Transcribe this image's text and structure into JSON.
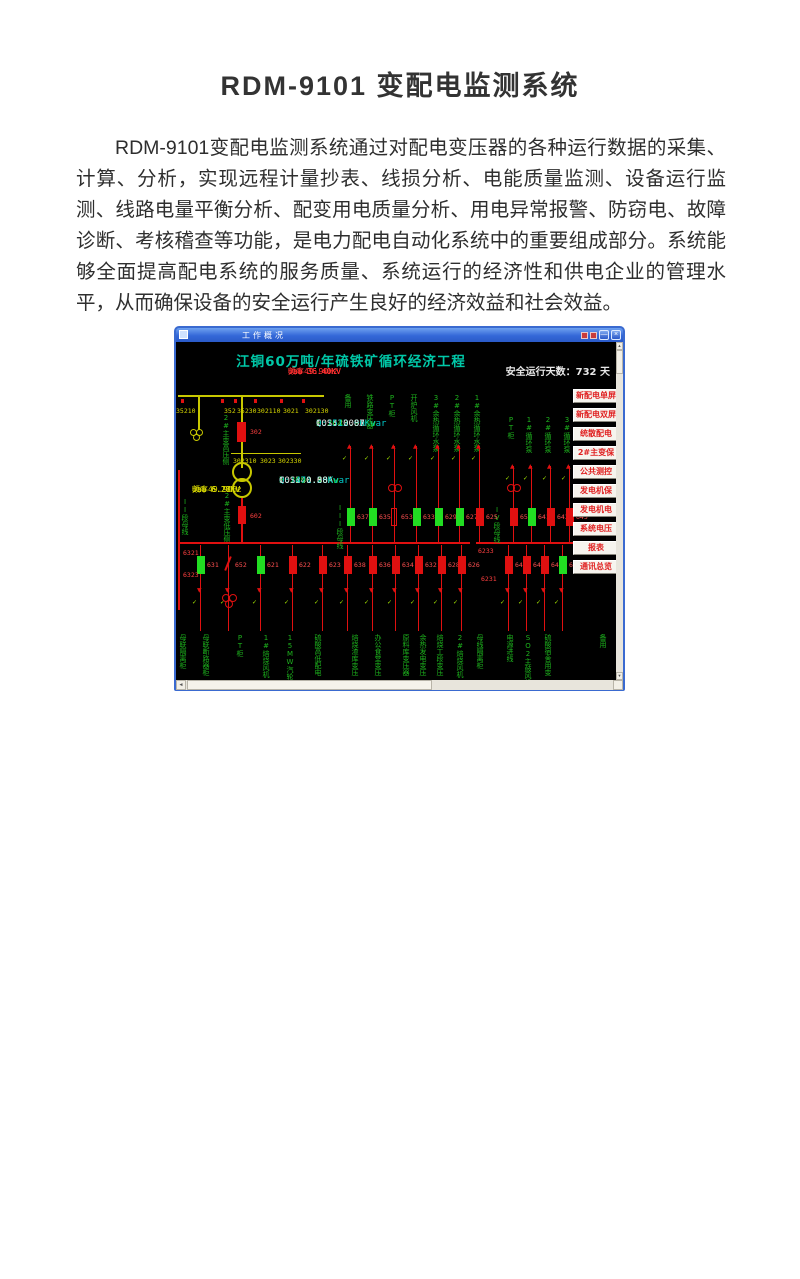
{
  "document": {
    "title": "RDM-9101 变配电监测系统",
    "paragraph": "RDM-9101变配电监测系统通过对配电变压器的各种运行数据的采集、计算、分析，实现远程计量抄表、线损分析、电能质量监测、设备运行监测、线路电量平衡分析、配变用电质量分析、用电异常报警、防窃电、故障诊断、考核稽查等功能，是电力配电自动化系统中的重要组成部分。系统能够全面提高配电系统的服务质量、系统运行的经济性和供电企业的管理水平，从而确保设备的安全运行产生良好的经济效益和社会效益。"
  },
  "window": {
    "title": "工作概况",
    "controls": {
      "minimize": "—",
      "close": "×"
    },
    "menu_buttons": [
      "新配电单屏",
      "新配电双屏",
      "统散配电",
      "2#主变保",
      "公共测控",
      "发电机保",
      "发电机电",
      "系统电压",
      "报表",
      "通讯总览"
    ],
    "scada": {
      "project_title": "江铜60万吨/年硫铁矿循环经济工程",
      "safe_days": "安全运行天数：732 天",
      "hv_readings": [
        "Uab 36.40KV",
        "Ubc 36.40KV",
        "Uca 36.40KV",
        "频率49.90Hz"
      ],
      "switch_row1": [
        "35210",
        "352",
        "35230",
        "302110",
        "3021",
        "302130"
      ],
      "switch_row2": [
        "302310",
        "3023",
        "302330"
      ],
      "breaker_302": "302",
      "hv_line_readings": [
        "I:  42.00A",
        "P:2643.90Kw",
        "Q:1512.00Kvar",
        "COS:  0.87"
      ],
      "label_hv_side": "2#主变高压侧",
      "label_lv_side": "2#主变低压侧",
      "lv_readings": [
        "Uab 6.27KV",
        "Ubc 6.28KV",
        "Uca 6.27KV",
        "频率49.90Hz"
      ],
      "lv_line_readings": [
        "I: 240.00A",
        "P:2690.40Kw",
        "Q:1471.20Kvar",
        "COS:  0.88"
      ],
      "breaker_602": "602",
      "bus_labels": {
        "bus2": "II段母线",
        "bus3": "III段母线",
        "bus4": "IV段母线"
      },
      "top_feeders_left": [
        {
          "label": "备用",
          "num": "637",
          "state": "closed"
        },
        {
          "label": "铁路变压器",
          "num": "635",
          "state": "closed"
        },
        {
          "label": "PT柜",
          "num": "653",
          "state": "hollow",
          "symbol": "circles"
        },
        {
          "label": "开炉风机",
          "num": "633",
          "state": "closed"
        },
        {
          "label": "3#余热循环水泵",
          "num": "629",
          "state": "closed"
        },
        {
          "label": "2#余热循环水泵",
          "num": "627",
          "state": "closed"
        },
        {
          "label": "1#余热循环水泵",
          "num": "625",
          "state": "open"
        }
      ],
      "top_feeders_right": [
        {
          "label": "PT柜",
          "num": "654",
          "state": "open",
          "symbol": "circles"
        },
        {
          "label": "1#循环泵",
          "num": "641",
          "state": "closed"
        },
        {
          "label": "2#循环泵",
          "num": "643",
          "state": "open"
        },
        {
          "label": "3#循环泵",
          "num": "645",
          "state": "open"
        }
      ],
      "bottom_feeders_left": [
        {
          "num": "631",
          "state": "closed"
        },
        {
          "num": "652",
          "state": "switch"
        },
        {
          "num": "621",
          "state": "closed"
        },
        {
          "num": "622",
          "state": "open"
        },
        {
          "num": "623",
          "state": "open"
        }
      ],
      "bottom_feeders_mid": [
        {
          "num": "638",
          "state": "open"
        },
        {
          "num": "636",
          "state": "open"
        },
        {
          "num": "634",
          "state": "open"
        },
        {
          "num": "632",
          "state": "open"
        },
        {
          "num": "628",
          "state": "open"
        },
        {
          "num": "626",
          "state": "open"
        }
      ],
      "bottom_feeders_right": [
        {
          "num": "642",
          "state": "open"
        },
        {
          "num": "644",
          "state": "open"
        },
        {
          "num": "646",
          "state": "open"
        },
        {
          "num": "648",
          "state": "closed"
        }
      ],
      "tap_labels": [
        "6321",
        "6323",
        "6233",
        "6231"
      ],
      "bottom_labels": [
        "母联隔离柜",
        "母联断路器柜",
        "PT柜",
        "1#焙烧风机",
        "15MW汽轮发电",
        "硫酸高低配电",
        "焙烧渣库变压",
        "办公食堂变压",
        "原料库变压器",
        "余热发电变压",
        "焙烧工段变压",
        "2#焙烧风机",
        "母线隔离柜",
        "电源进线",
        "SO2主鼓风机",
        "硫酸宿舍用变",
        "备用"
      ]
    },
    "colors": {
      "teal": "#00c8a8",
      "red": "#e01010",
      "green": "#1db31d",
      "yellow": "#d8d800",
      "cyan": "#00cccc",
      "menu_text": "#e02020"
    }
  }
}
